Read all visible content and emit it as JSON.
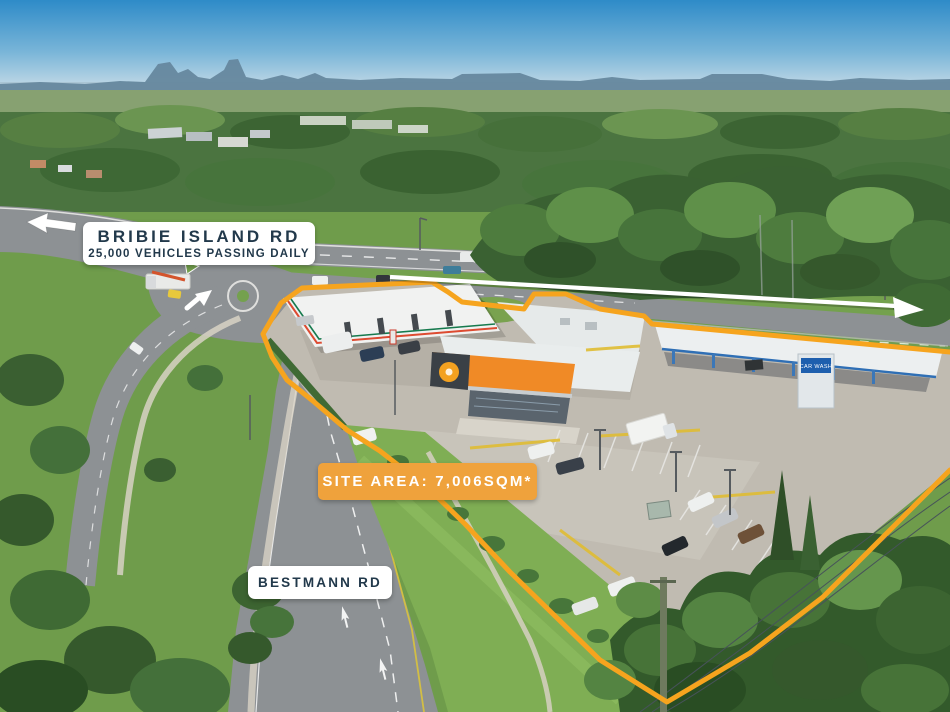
{
  "scene": {
    "type": "aerial-property-marketing-photo",
    "description": "Aerial photo of a service station site on the corner of Bribie Island Rd and Bestmann Rd, outlined in orange"
  },
  "labels": {
    "primary_road": {
      "name": "BRIBIE ISLAND RD",
      "traffic": "25,000 VEHICLES PASSING DAILY"
    },
    "site_area": "SITE AREA: 7,006SQM*",
    "secondary_road": "BESTMANN RD",
    "car_wash_sign": "CAR WASH"
  },
  "site": {
    "area_sqm": "7,006",
    "boundary_color": "#F6A41E"
  },
  "annotations": {
    "arrows": [
      {
        "name": "eastbound-traffic-arrow",
        "direction": "east",
        "color": "#FFFFFF"
      },
      {
        "name": "westbound-traffic-arrow",
        "direction": "west",
        "color": "#FFFFFF"
      },
      {
        "name": "roundabout-exit-arrow",
        "direction": "northeast",
        "color": "#FFFFFF"
      }
    ]
  },
  "colors": {
    "site_area_box": "#EFA23C",
    "label_box": "#FFFFFF",
    "label_text": "#22394B",
    "boundary": "#F6A41E",
    "arrow": "#FFFFFF"
  }
}
